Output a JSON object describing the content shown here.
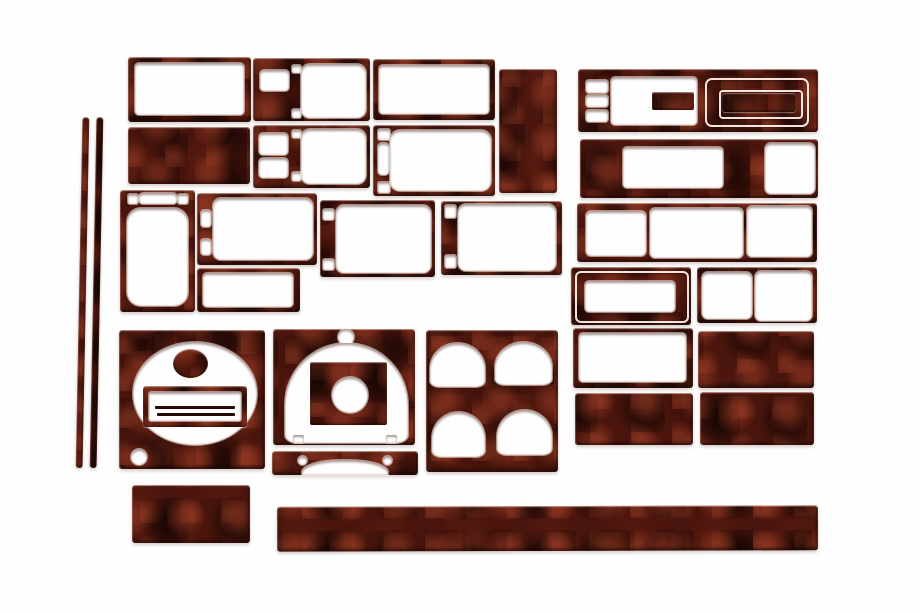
{
  "scene": {
    "title": "Wood grain dash trim kit - product photo",
    "background_color": "#fefefe",
    "piece_count": 29,
    "wood_palette": {
      "base": "#4a150d",
      "dark_mottle": "#1c0603",
      "light_mottle": "#9e3e26",
      "specular_edge": "#ffd6c4",
      "cutout_fill": "#fefefe"
    }
  },
  "pieces": [
    {
      "name": "pillar-trim-strip-1",
      "kind": "strip",
      "x": 79,
      "y": 117,
      "w": 7,
      "h": 351,
      "rotate": 1.1
    },
    {
      "name": "pillar-trim-strip-2",
      "kind": "strip",
      "x": 93,
      "y": 117,
      "w": 7,
      "h": 351,
      "rotate": 1.1
    },
    {
      "name": "rect-bezel-top-left",
      "kind": "frame",
      "x": 128,
      "y": 57,
      "w": 123,
      "h": 65,
      "features": [
        {
          "t": "hole",
          "name": "bezel-opening",
          "x": 7,
          "y": 6,
          "w": 109,
          "h": 52,
          "r": 4
        }
      ]
    },
    {
      "name": "vent-bezel-upper",
      "kind": "frame",
      "x": 253,
      "y": 58,
      "w": 117,
      "h": 63,
      "features": [
        {
          "t": "hole",
          "name": "switch-opening",
          "x": 7,
          "y": 12,
          "w": 29,
          "h": 21,
          "r": 4
        },
        {
          "t": "hole",
          "name": "clip-slot-top",
          "x": 39,
          "y": 7,
          "w": 9,
          "h": 8,
          "r": 2
        },
        {
          "t": "hole",
          "name": "clip-slot-bottom",
          "x": 39,
          "y": 51,
          "w": 9,
          "h": 9,
          "r": 2
        },
        {
          "t": "hole",
          "name": "vent-opening",
          "x": 48,
          "y": 6,
          "w": 65,
          "h": 54,
          "r": 9
        }
      ]
    },
    {
      "name": "rect-bezel-top-mid",
      "kind": "frame",
      "x": 373,
      "y": 59,
      "w": 122,
      "h": 61,
      "features": [
        {
          "t": "hole",
          "name": "bezel-opening",
          "x": 6,
          "y": 6,
          "w": 110,
          "h": 49,
          "r": 4
        }
      ]
    },
    {
      "name": "blank-plate-tall",
      "kind": "solid",
      "x": 499,
      "y": 69,
      "w": 58,
      "h": 124
    },
    {
      "name": "radio-surround-upper",
      "kind": "frame",
      "x": 578,
      "y": 69,
      "w": 240,
      "h": 63,
      "features": [
        {
          "t": "hole",
          "name": "button-hole-1",
          "x": 8,
          "y": 11,
          "w": 22,
          "h": 13,
          "r": 3
        },
        {
          "t": "hole",
          "name": "button-hole-2",
          "x": 8,
          "y": 26,
          "w": 22,
          "h": 12,
          "r": 3
        },
        {
          "t": "hole",
          "name": "button-hole-3",
          "x": 8,
          "y": 41,
          "w": 22,
          "h": 12,
          "r": 3
        },
        {
          "t": "hole",
          "name": "left-opening",
          "x": 33,
          "y": 8,
          "w": 86,
          "h": 48,
          "r": 4
        },
        {
          "t": "fwood",
          "name": "center-tab",
          "x": 74,
          "y": 23,
          "w": 42,
          "h": 18,
          "r": 2
        },
        {
          "t": "ring",
          "name": "display-outer-groove",
          "x": 127,
          "y": 9,
          "w": 100,
          "h": 45,
          "r": 7
        },
        {
          "t": "ring",
          "name": "display-inner-groove",
          "x": 141,
          "y": 21,
          "w": 80,
          "h": 25,
          "r": 4
        },
        {
          "t": "fwood",
          "name": "display-pad",
          "x": 144,
          "y": 24,
          "w": 74,
          "h": 19,
          "r": 3,
          "dark": true
        }
      ]
    },
    {
      "name": "blank-plate-a",
      "kind": "solid",
      "x": 128,
      "y": 127,
      "w": 122,
      "h": 57
    },
    {
      "name": "vent-bezel-lower",
      "kind": "frame",
      "x": 253,
      "y": 125,
      "w": 117,
      "h": 63,
      "features": [
        {
          "t": "hole",
          "name": "switch-opening-top",
          "x": 6,
          "y": 8,
          "w": 29,
          "h": 22,
          "r": 4
        },
        {
          "t": "hole",
          "name": "switch-opening-bottom",
          "x": 6,
          "y": 33,
          "w": 29,
          "h": 20,
          "r": 4
        },
        {
          "t": "hole",
          "name": "clip-slot-top",
          "x": 39,
          "y": 5,
          "w": 9,
          "h": 8,
          "r": 2
        },
        {
          "t": "hole",
          "name": "clip-slot-bottom",
          "x": 39,
          "y": 47,
          "w": 9,
          "h": 9,
          "r": 2
        },
        {
          "t": "hole",
          "name": "vent-opening",
          "x": 48,
          "y": 4,
          "w": 65,
          "h": 55,
          "r": 9
        }
      ]
    },
    {
      "name": "side-vent-bezel-left",
      "kind": "frame",
      "x": 373,
      "y": 125,
      "w": 122,
      "h": 71,
      "features": [
        {
          "t": "hole",
          "name": "clip-hole-top",
          "x": 5,
          "y": 4,
          "w": 12,
          "h": 11,
          "r": 2
        },
        {
          "t": "hole",
          "name": "side-slot",
          "x": 5,
          "y": 18,
          "w": 11,
          "h": 32,
          "r": 4
        },
        {
          "t": "hole",
          "name": "clip-hole-bottom",
          "x": 5,
          "y": 57,
          "w": 12,
          "h": 11,
          "r": 2
        },
        {
          "t": "hole",
          "name": "vent-opening",
          "x": 17,
          "y": 5,
          "w": 101,
          "h": 61,
          "r": 10
        }
      ]
    },
    {
      "name": "radio-surround-lower",
      "kind": "frame",
      "x": 580,
      "y": 139,
      "w": 238,
      "h": 59,
      "features": [
        {
          "t": "hole",
          "name": "center-opening",
          "x": 43,
          "y": 8,
          "w": 100,
          "h": 41,
          "r": 4
        },
        {
          "t": "hole",
          "name": "right-opening",
          "x": 185,
          "y": 4,
          "w": 50,
          "h": 51,
          "r": 6
        }
      ]
    },
    {
      "name": "console-panel-tall",
      "kind": "frame",
      "x": 120,
      "y": 190,
      "w": 75,
      "h": 122,
      "features": [
        {
          "t": "hole",
          "name": "clip-hole-left",
          "x": 8,
          "y": 4,
          "w": 10,
          "h": 10,
          "r": 2
        },
        {
          "t": "hole",
          "name": "top-slot",
          "x": 19,
          "y": 3,
          "w": 38,
          "h": 11,
          "r": 4
        },
        {
          "t": "hole",
          "name": "clip-hole-right",
          "x": 58,
          "y": 4,
          "w": 10,
          "h": 10,
          "r": 2
        },
        {
          "t": "hole",
          "name": "main-opening",
          "x": 7,
          "y": 18,
          "w": 61,
          "h": 98,
          "r": 14
        }
      ]
    },
    {
      "name": "vent-bezel-mid-left",
      "kind": "frame",
      "x": 197,
      "y": 193,
      "w": 120,
      "h": 72,
      "features": [
        {
          "t": "hole",
          "name": "side-slot-top",
          "x": 4,
          "y": 17,
          "w": 10,
          "h": 17,
          "r": 3
        },
        {
          "t": "hole",
          "name": "side-slot-bottom",
          "x": 4,
          "y": 46,
          "w": 10,
          "h": 16,
          "r": 3
        },
        {
          "t": "hole",
          "name": "vent-opening",
          "x": 16,
          "y": 5,
          "w": 100,
          "h": 62,
          "r": 8
        }
      ]
    },
    {
      "name": "vent-bezel-mid-center",
      "kind": "frame",
      "x": 320,
      "y": 200,
      "w": 115,
      "h": 77,
      "features": [
        {
          "t": "hole",
          "name": "clip-hole-top",
          "x": 3,
          "y": 9,
          "w": 11,
          "h": 11,
          "r": 2
        },
        {
          "t": "hole",
          "name": "clip-hole-bottom",
          "x": 3,
          "y": 59,
          "w": 11,
          "h": 11,
          "r": 2
        },
        {
          "t": "hole",
          "name": "vent-opening",
          "x": 16,
          "y": 5,
          "w": 95,
          "h": 68,
          "r": 8
        }
      ]
    },
    {
      "name": "vent-bezel-mid-right",
      "kind": "frame",
      "x": 441,
      "y": 201,
      "w": 121,
      "h": 74,
      "features": [
        {
          "t": "hole",
          "name": "clip-hole-top",
          "x": 4,
          "y": 4,
          "w": 11,
          "h": 13,
          "r": 2
        },
        {
          "t": "hole",
          "name": "clip-hole-bottom",
          "x": 4,
          "y": 54,
          "w": 11,
          "h": 13,
          "r": 2
        },
        {
          "t": "hole",
          "name": "vent-opening",
          "x": 17,
          "y": 3,
          "w": 98,
          "h": 67,
          "r": 8
        }
      ]
    },
    {
      "name": "triple-opening-panel",
      "kind": "frame",
      "x": 577,
      "y": 203,
      "w": 240,
      "h": 59,
      "features": [
        {
          "t": "hole",
          "name": "opening-left",
          "x": 9,
          "y": 8,
          "w": 60,
          "h": 45,
          "r": 5
        },
        {
          "t": "hole",
          "name": "opening-center",
          "x": 73,
          "y": 5,
          "w": 93,
          "h": 50,
          "r": 5
        },
        {
          "t": "hole",
          "name": "opening-right",
          "x": 170,
          "y": 3,
          "w": 65,
          "h": 51,
          "r": 5
        }
      ]
    },
    {
      "name": "small-rect-bezel",
      "kind": "frame",
      "x": 197,
      "y": 268,
      "w": 103,
      "h": 44,
      "features": [
        {
          "t": "hole",
          "name": "bezel-opening",
          "x": 6,
          "y": 5,
          "w": 90,
          "h": 34,
          "r": 4
        }
      ]
    },
    {
      "name": "double-groove-bezel",
      "kind": "frame",
      "x": 571,
      "y": 267,
      "w": 120,
      "h": 58,
      "features": [
        {
          "t": "ring",
          "name": "outer-groove",
          "x": 4,
          "y": 4,
          "w": 110,
          "h": 48,
          "r": 6
        },
        {
          "t": "hole",
          "name": "center-opening",
          "x": 14,
          "y": 14,
          "w": 90,
          "h": 31,
          "r": 4
        }
      ]
    },
    {
      "name": "dual-opening-bezel",
      "kind": "frame",
      "x": 697,
      "y": 267,
      "w": 120,
      "h": 56,
      "features": [
        {
          "t": "hole",
          "name": "opening-left",
          "x": 5,
          "y": 5,
          "w": 50,
          "h": 47,
          "r": 6
        },
        {
          "t": "hole",
          "name": "opening-right",
          "x": 58,
          "y": 4,
          "w": 57,
          "h": 50,
          "r": 6
        }
      ]
    },
    {
      "name": "gauge-panel",
      "kind": "panel",
      "x": 119,
      "y": 330,
      "w": 146,
      "h": 139,
      "features": [
        {
          "t": "hole",
          "name": "gauge-dial-opening",
          "x": 14,
          "y": 12,
          "w": 124,
          "h": 103,
          "r": "50%"
        },
        {
          "t": "fwood",
          "name": "gauge-hub",
          "x": 54,
          "y": 19,
          "w": 35,
          "h": 29,
          "r": "50%"
        },
        {
          "t": "fwood",
          "name": "display-frame",
          "x": 24,
          "y": 56,
          "w": 104,
          "h": 41,
          "r": 3
        },
        {
          "t": "hole",
          "name": "display-window",
          "x": 30,
          "y": 62,
          "w": 92,
          "h": 29,
          "r": 2
        },
        {
          "t": "fline",
          "name": "display-slot-1",
          "x": 36,
          "y": 76,
          "w": 80,
          "h": 3
        },
        {
          "t": "fline",
          "name": "display-slot-2",
          "x": 38,
          "y": 83,
          "w": 78,
          "h": 3
        },
        {
          "t": "hole",
          "name": "corner-hole",
          "x": 12,
          "y": 119,
          "w": 16,
          "h": 16,
          "r": "50%"
        }
      ]
    },
    {
      "name": "cluster-hood-panel",
      "kind": "panel",
      "x": 273,
      "y": 329,
      "w": 142,
      "h": 116,
      "features": [
        {
          "t": "hole",
          "name": "top-sensor-hole",
          "x": 65,
          "y": 0,
          "w": 16,
          "h": 16,
          "r": "50%"
        },
        {
          "t": "hole",
          "name": "cluster-arch-opening",
          "x": 12,
          "y": 14,
          "w": 123,
          "h": 100,
          "r": "50% 50% 10% 10% / 62% 62% 8% 8%"
        },
        {
          "t": "fwood",
          "name": "center-block",
          "x": 37,
          "y": 33,
          "w": 77,
          "h": 63,
          "r": 2
        },
        {
          "t": "hole",
          "name": "steering-column-hole",
          "x": 59,
          "y": 48,
          "w": 36,
          "h": 36,
          "r": "50%"
        },
        {
          "t": "hole",
          "name": "notch-left",
          "x": 20,
          "y": 106,
          "w": 11,
          "h": 8,
          "r": 2
        },
        {
          "t": "hole",
          "name": "notch-right",
          "x": 113,
          "y": 106,
          "w": 11,
          "h": 8,
          "r": 2
        }
      ]
    },
    {
      "name": "column-lower-strip",
      "kind": "panel",
      "x": 272,
      "y": 451,
      "w": 146,
      "h": 24,
      "features": [
        {
          "t": "hole",
          "name": "arch-cutout",
          "x": 30,
          "y": 9,
          "w": 86,
          "h": 15,
          "r": "45% 45% 0 0 / 80% 80% 0 0"
        },
        {
          "t": "hole",
          "name": "shoulder-notch-left",
          "x": 26,
          "y": 5,
          "w": 9,
          "h": 9,
          "r": "50%"
        },
        {
          "t": "hole",
          "name": "shoulder-notch-right",
          "x": 111,
          "y": 5,
          "w": 9,
          "h": 9,
          "r": "50%"
        }
      ]
    },
    {
      "name": "quad-gauge-panel",
      "kind": "panel",
      "x": 426,
      "y": 330,
      "w": 132,
      "h": 142,
      "features": [
        {
          "t": "hole",
          "name": "gauge-hole-top-left",
          "x": 4,
          "y": 13,
          "w": 55,
          "h": 44,
          "r": "50% 50% 18% 18% / 58% 58% 14% 14%"
        },
        {
          "t": "hole",
          "name": "gauge-hole-top-right",
          "x": 69,
          "y": 12,
          "w": 57,
          "h": 43,
          "r": "50% 50% 18% 18% / 58% 58% 14% 14%"
        },
        {
          "t": "hole",
          "name": "gauge-hole-bottom-left",
          "x": 6,
          "y": 82,
          "w": 53,
          "h": 45,
          "r": "50% 50% 18% 18% / 58% 58% 14% 14%"
        },
        {
          "t": "hole",
          "name": "gauge-hole-bottom-right",
          "x": 71,
          "y": 80,
          "w": 55,
          "h": 45,
          "r": "50% 50% 18% 18% / 58% 58% 14% 14%"
        }
      ]
    },
    {
      "name": "rect-bezel-lower-right",
      "kind": "frame",
      "x": 573,
      "y": 328,
      "w": 120,
      "h": 60,
      "features": [
        {
          "t": "hole",
          "name": "bezel-opening",
          "x": 6,
          "y": 5,
          "w": 107,
          "h": 49,
          "r": 4
        }
      ]
    },
    {
      "name": "blank-plate-b",
      "kind": "solid",
      "x": 698,
      "y": 331,
      "w": 116,
      "h": 57
    },
    {
      "name": "blank-plate-c",
      "kind": "solid",
      "x": 575,
      "y": 393,
      "w": 118,
      "h": 52
    },
    {
      "name": "blank-plate-d",
      "kind": "solid",
      "x": 700,
      "y": 392,
      "w": 114,
      "h": 53
    },
    {
      "name": "blank-plate-e",
      "kind": "solid",
      "x": 132,
      "y": 485,
      "w": 118,
      "h": 58
    },
    {
      "name": "sill-trim-long-strip",
      "kind": "strip",
      "x": 277,
      "y": 506,
      "w": 541,
      "h": 45,
      "rotate": -0.15
    }
  ]
}
